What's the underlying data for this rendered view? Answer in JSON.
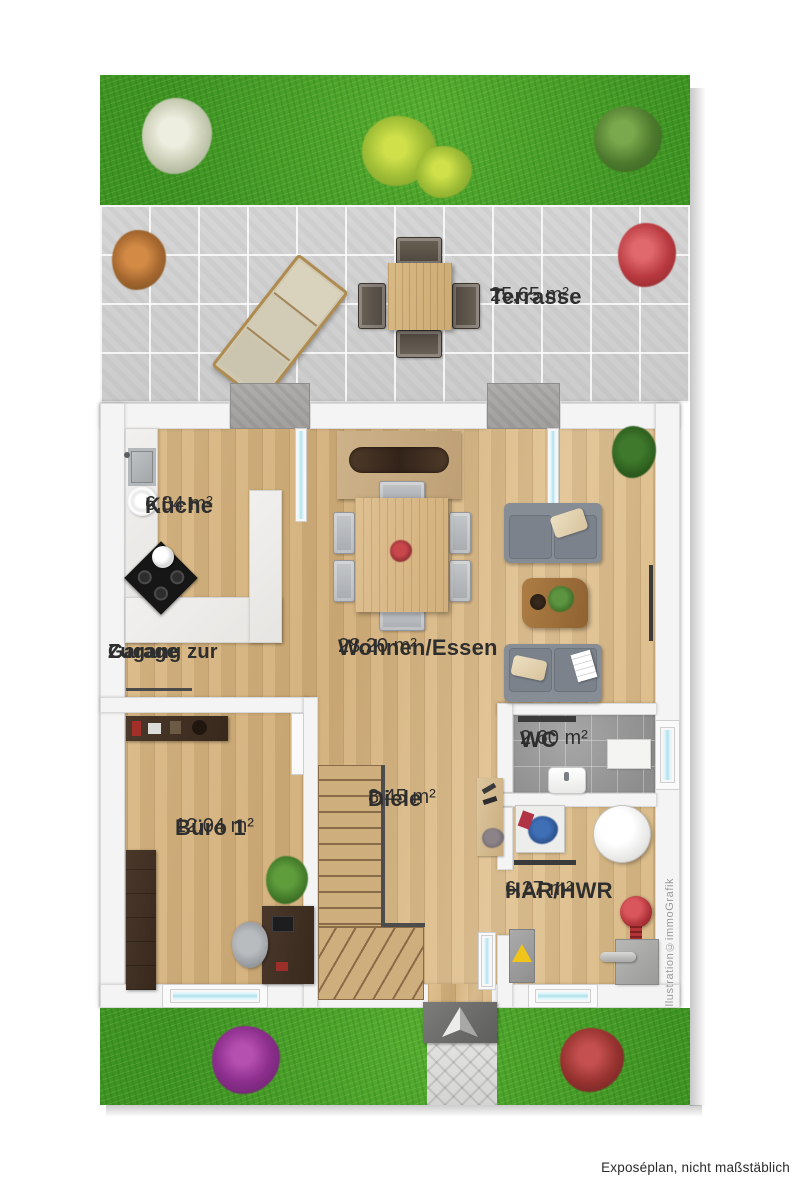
{
  "meta": {
    "footer_note": "Exposéplan, nicht maßstäblich",
    "watermark": "Illustration©immoGrafik"
  },
  "outdoor": {
    "terrace": {
      "name": "Terrasse",
      "area": "25,65 m²"
    }
  },
  "garage_access": {
    "line1": "Zugang zur",
    "line2": "Garage"
  },
  "rooms": [
    {
      "name": "Küche",
      "area": "6,84 m²"
    },
    {
      "name": "Wohnen/Essen",
      "area": "28,20 m²"
    },
    {
      "name": "Büro 1",
      "area": "12,04 m²"
    },
    {
      "name": "Diele",
      "area": "8,45 m²"
    },
    {
      "name": "WC",
      "area": "2,60 m²"
    },
    {
      "name": "HAR/HWR",
      "area": "6,27 m²"
    }
  ],
  "colors": {
    "grass": "#469e27",
    "terrace_tile": "#d0d0d0",
    "wood_floor": "#d8b681",
    "wall": "#f4f4f4",
    "window_glass": "#aee2ee",
    "label_text": "#2e2e2e"
  }
}
